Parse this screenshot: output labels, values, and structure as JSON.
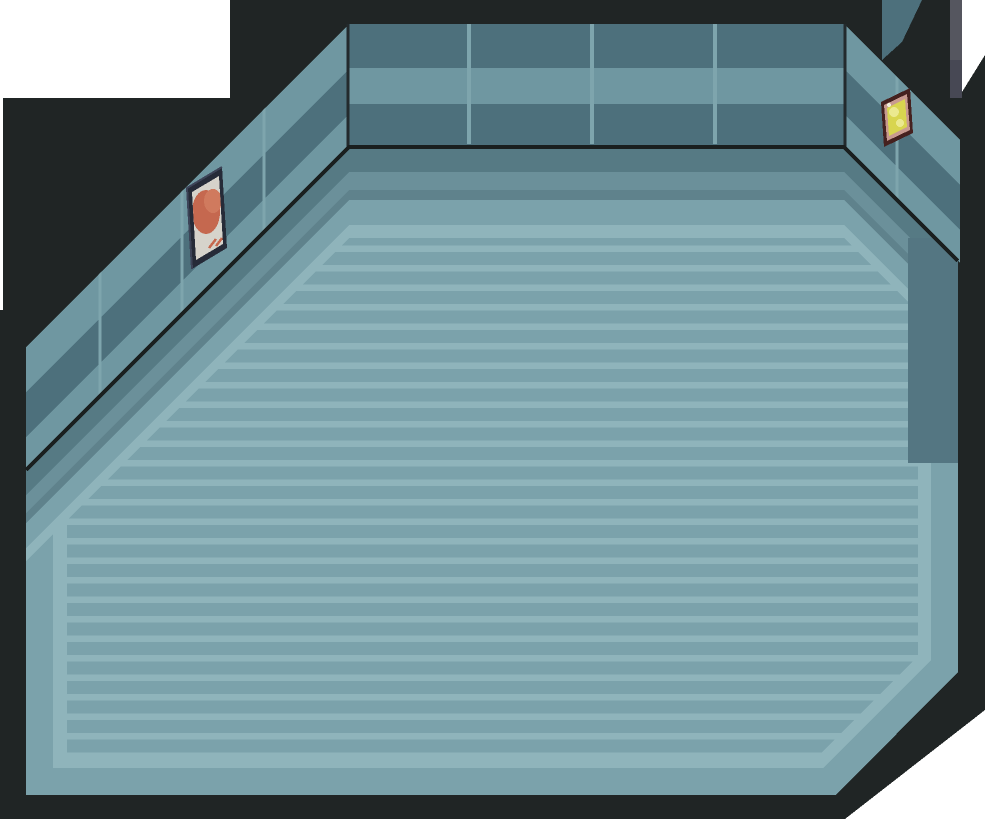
{
  "scene": {
    "name": "game-room-interior",
    "description": "Top-down pixel-art style game room with teal walls, striped floor, a wall poster on the left wall and a small yellow sign on the right wall",
    "objects": {
      "poster_label": "wall-poster",
      "sign_label": "wall-sign",
      "doorway_label": "doorway-edge"
    }
  },
  "colors": {
    "background": "#ffffff",
    "border_black": "#202525",
    "edge_line": "#1a1f1f",
    "corner_line": "#232a2d",
    "wall_dark": "#4d707c",
    "wall_light": "#6f97a1",
    "wall_seam": "#7ea5ad",
    "floor_stripe_light": "#8fb4bb",
    "floor_stripe_dark": "#7ba2ab",
    "floor_ring_med": "#7ba2ab",
    "floor_ring_light": "#8fb4bb",
    "floor_shadow_1": "#567a84",
    "floor_shadow_2": "#6b909a",
    "floor_shadow_3": "#5f828c",
    "floor_shadow_right": "#547682",
    "doorway_gray": "#55565f",
    "doorway_gray_dark": "#474854",
    "poster_frame": "#262b38",
    "poster_frame_hi": "#3d4458",
    "poster_paper": "#d6d3cb",
    "poster_art": "#c5684f",
    "poster_art_hi": "#d07a5e",
    "sign_frame": "#45211f",
    "sign_border": "#c89a90",
    "sign_face": "#d8d54f",
    "sign_glyph": "#ebe98f",
    "sign_glint": "#f0ecd9"
  }
}
